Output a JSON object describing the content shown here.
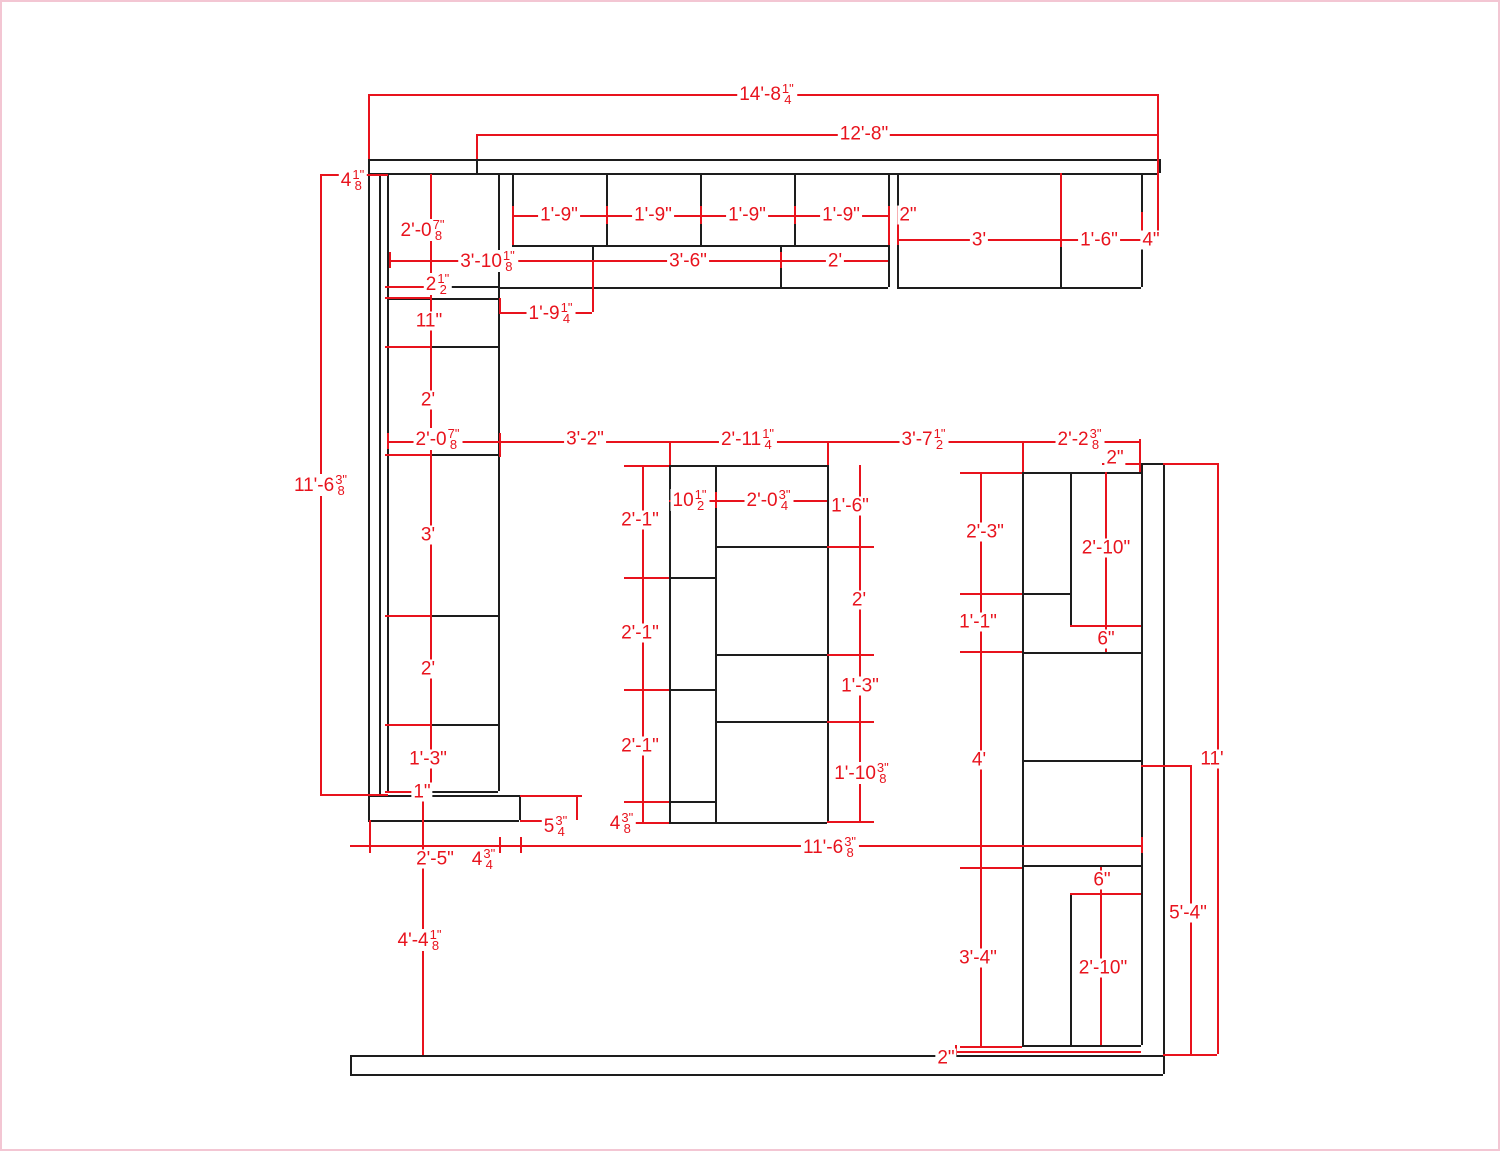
{
  "drawing": {
    "title": "cabinet-layout-plan",
    "colors": {
      "background": "#ffffff",
      "page_border": "#f3c6d3",
      "cabinet_line": "#1d1d1d",
      "dimension_line": "#e8131d"
    },
    "cabinet_lines": [
      [
        366,
        157,
        1157,
        157
      ],
      [
        366,
        171,
        1157,
        171
      ],
      [
        1157,
        157,
        1157,
        171
      ],
      [
        474,
        157,
        474,
        171
      ],
      [
        366,
        157,
        366,
        818
      ],
      [
        377,
        171,
        377,
        793
      ],
      [
        385,
        171,
        385,
        789
      ],
      [
        496,
        171,
        496,
        789
      ],
      [
        385,
        284,
        496,
        284
      ],
      [
        385,
        296,
        496,
        296
      ],
      [
        385,
        344,
        496,
        344
      ],
      [
        385,
        452,
        496,
        452
      ],
      [
        385,
        613,
        496,
        613
      ],
      [
        385,
        722,
        496,
        722
      ],
      [
        385,
        789,
        496,
        789
      ],
      [
        366,
        793,
        517,
        793
      ],
      [
        366,
        818,
        517,
        818
      ],
      [
        517,
        793,
        517,
        818
      ],
      [
        510,
        171,
        510,
        243
      ],
      [
        604,
        171,
        604,
        243
      ],
      [
        698,
        171,
        698,
        243
      ],
      [
        792,
        171,
        792,
        243
      ],
      [
        886,
        171,
        886,
        285
      ],
      [
        895,
        171,
        895,
        285
      ],
      [
        510,
        243,
        886,
        243
      ],
      [
        496,
        285,
        886,
        285
      ],
      [
        590,
        243,
        590,
        285
      ],
      [
        778,
        243,
        778,
        285
      ],
      [
        1058,
        171,
        1058,
        285
      ],
      [
        1139,
        171,
        1139,
        285
      ],
      [
        895,
        285,
        1139,
        285
      ],
      [
        667,
        463,
        825,
        463
      ],
      [
        667,
        820,
        825,
        820
      ],
      [
        667,
        463,
        667,
        820
      ],
      [
        713,
        463,
        713,
        820
      ],
      [
        825,
        463,
        825,
        820
      ],
      [
        667,
        575,
        713,
        575
      ],
      [
        667,
        687,
        713,
        687
      ],
      [
        667,
        799,
        713,
        799
      ],
      [
        713,
        544,
        825,
        544
      ],
      [
        713,
        652,
        825,
        652
      ],
      [
        713,
        719,
        825,
        719
      ],
      [
        1139,
        461,
        1139,
        1043
      ],
      [
        1161,
        461,
        1161,
        1072
      ],
      [
        1139,
        461,
        1161,
        461
      ],
      [
        1020,
        470,
        1020,
        1043
      ],
      [
        1020,
        470,
        1139,
        470
      ],
      [
        1068,
        470,
        1068,
        623
      ],
      [
        1020,
        591,
        1068,
        591
      ],
      [
        1068,
        623,
        1139,
        623
      ],
      [
        1020,
        650,
        1139,
        650
      ],
      [
        1020,
        758,
        1139,
        758
      ],
      [
        1020,
        863,
        1139,
        863
      ],
      [
        1068,
        891,
        1139,
        891
      ],
      [
        1068,
        891,
        1068,
        1043
      ],
      [
        1020,
        1043,
        1139,
        1043
      ],
      [
        348,
        1053,
        1161,
        1053
      ],
      [
        348,
        1072,
        1161,
        1072
      ],
      [
        348,
        1053,
        348,
        1072
      ]
    ],
    "dimension_lines": [
      [
        366,
        92,
        1155,
        92
      ],
      [
        366,
        92,
        366,
        157
      ],
      [
        1155,
        92,
        1155,
        240
      ],
      [
        474,
        132,
        1155,
        132
      ],
      [
        474,
        132,
        474,
        157
      ],
      [
        318,
        172,
        386,
        172
      ],
      [
        318,
        172,
        318,
        792
      ],
      [
        318,
        792,
        386,
        792
      ],
      [
        428,
        172,
        428,
        789
      ],
      [
        510,
        213,
        886,
        213
      ],
      [
        510,
        204,
        510,
        243
      ],
      [
        604,
        204,
        604,
        222
      ],
      [
        698,
        204,
        698,
        222
      ],
      [
        792,
        204,
        792,
        222
      ],
      [
        886,
        204,
        886,
        243
      ],
      [
        895,
        204,
        895,
        243
      ],
      [
        895,
        237,
        1157,
        237
      ],
      [
        1058,
        171,
        1058,
        245
      ],
      [
        1139,
        210,
        1139,
        245
      ],
      [
        387,
        258,
        886,
        258
      ],
      [
        387,
        250,
        387,
        266
      ],
      [
        590,
        258,
        590,
        310
      ],
      [
        778,
        250,
        778,
        266
      ],
      [
        383,
        284,
        428,
        284
      ],
      [
        383,
        295,
        428,
        295
      ],
      [
        383,
        344,
        428,
        344
      ],
      [
        497,
        310,
        590,
        310
      ],
      [
        497,
        296,
        497,
        310
      ],
      [
        383,
        452,
        428,
        452
      ],
      [
        383,
        613,
        428,
        613
      ],
      [
        383,
        722,
        428,
        722
      ],
      [
        383,
        789,
        428,
        789
      ],
      [
        385,
        439,
        1139,
        439
      ],
      [
        385,
        431,
        385,
        447
      ],
      [
        497,
        431,
        497,
        455
      ],
      [
        667,
        439,
        667,
        463
      ],
      [
        825,
        439,
        825,
        463
      ],
      [
        1020,
        439,
        1020,
        470
      ],
      [
        1137,
        437,
        1137,
        470
      ],
      [
        622,
        463,
        667,
        463
      ],
      [
        622,
        575,
        667,
        575
      ],
      [
        622,
        687,
        667,
        687
      ],
      [
        622,
        799,
        667,
        799
      ],
      [
        622,
        820,
        667,
        820
      ],
      [
        640,
        463,
        640,
        820
      ],
      [
        667,
        498,
        825,
        498
      ],
      [
        713,
        490,
        713,
        506
      ],
      [
        857,
        463,
        857,
        819
      ],
      [
        825,
        544,
        872,
        544
      ],
      [
        825,
        652,
        872,
        652
      ],
      [
        825,
        719,
        872,
        719
      ],
      [
        825,
        819,
        872,
        819
      ],
      [
        978,
        470,
        978,
        1044
      ],
      [
        958,
        470,
        1020,
        470
      ],
      [
        958,
        591,
        1020,
        591
      ],
      [
        958,
        649,
        1020,
        649
      ],
      [
        958,
        865,
        1020,
        865
      ],
      [
        958,
        1044,
        1020,
        1044
      ],
      [
        1103,
        470,
        1103,
        650
      ],
      [
        1068,
        623,
        1139,
        623
      ],
      [
        1100,
        461,
        1137,
        461
      ],
      [
        1161,
        461,
        1215,
        461
      ],
      [
        1215,
        461,
        1215,
        1052
      ],
      [
        1161,
        1052,
        1215,
        1052
      ],
      [
        1139,
        763,
        1188,
        763
      ],
      [
        1188,
        763,
        1188,
        1052
      ],
      [
        1098,
        865,
        1098,
        1043
      ],
      [
        1068,
        891,
        1139,
        891
      ],
      [
        953,
        1049,
        1139,
        1049
      ],
      [
        953,
        1043,
        953,
        1053
      ],
      [
        348,
        843,
        1139,
        843
      ],
      [
        367,
        818,
        367,
        851
      ],
      [
        497,
        835,
        497,
        851
      ],
      [
        518,
        835,
        518,
        851
      ],
      [
        1139,
        835,
        1139,
        851
      ],
      [
        518,
        793,
        580,
        793
      ],
      [
        574,
        793,
        574,
        818
      ],
      [
        518,
        818,
        563,
        818
      ],
      [
        420,
        793,
        420,
        1053
      ]
    ],
    "dimension_labels": [
      {
        "x": 765,
        "y": 92,
        "text": "14'-8",
        "num": "1\"",
        "den": "4"
      },
      {
        "x": 862,
        "y": 132,
        "text": "12'-8\""
      },
      {
        "x": 351,
        "y": 178,
        "text": "4",
        "num": "1\"",
        "den": "8"
      },
      {
        "x": 557,
        "y": 213,
        "text": "1'-9\""
      },
      {
        "x": 651,
        "y": 213,
        "text": "1'-9\""
      },
      {
        "x": 745,
        "y": 213,
        "text": "1'-9\""
      },
      {
        "x": 839,
        "y": 213,
        "text": "1'-9\""
      },
      {
        "x": 906,
        "y": 213,
        "text": "2\""
      },
      {
        "x": 977,
        "y": 238,
        "text": "3'"
      },
      {
        "x": 1097,
        "y": 238,
        "text": "1'-6\""
      },
      {
        "x": 1149,
        "y": 238,
        "text": "4\""
      },
      {
        "x": 421,
        "y": 228,
        "text": "2'-0",
        "num": "7\"",
        "den": "8"
      },
      {
        "x": 486,
        "y": 259,
        "text": "3'-10",
        "num": "1\"",
        "den": "8"
      },
      {
        "x": 686,
        "y": 259,
        "text": "3'-6\""
      },
      {
        "x": 833,
        "y": 259,
        "text": "2'"
      },
      {
        "x": 436,
        "y": 282,
        "text": "2",
        "num": "1\"",
        "den": "2"
      },
      {
        "x": 427,
        "y": 319,
        "text": "11\""
      },
      {
        "x": 549,
        "y": 311,
        "text": "1'-9",
        "num": "1\"",
        "den": "4"
      },
      {
        "x": 426,
        "y": 398,
        "text": "2'"
      },
      {
        "x": 319,
        "y": 483,
        "text": "11'-6",
        "num": "3\"",
        "den": "8"
      },
      {
        "x": 436,
        "y": 437,
        "text": "2'-0",
        "num": "7\"",
        "den": "8"
      },
      {
        "x": 583,
        "y": 437,
        "text": "3'-2\""
      },
      {
        "x": 746,
        "y": 437,
        "text": "2'-11",
        "num": "1\"",
        "den": "4"
      },
      {
        "x": 922,
        "y": 437,
        "text": "3'-7",
        "num": "1\"",
        "den": "2"
      },
      {
        "x": 1078,
        "y": 437,
        "text": "2'-2",
        "num": "3\"",
        "den": "8"
      },
      {
        "x": 1113,
        "y": 456,
        "text": "2\""
      },
      {
        "x": 688,
        "y": 498,
        "text": "10",
        "num": "1\"",
        "den": "2"
      },
      {
        "x": 767,
        "y": 498,
        "text": "2'-0",
        "num": "3\"",
        "den": "4"
      },
      {
        "x": 848,
        "y": 504,
        "text": "1'-6\""
      },
      {
        "x": 638,
        "y": 518,
        "text": "2'-1\""
      },
      {
        "x": 983,
        "y": 530,
        "text": "2'-3\""
      },
      {
        "x": 426,
        "y": 533,
        "text": "3'"
      },
      {
        "x": 1104,
        "y": 546,
        "text": "2'-10\""
      },
      {
        "x": 857,
        "y": 598,
        "text": "2'"
      },
      {
        "x": 976,
        "y": 620,
        "text": "1'-1\""
      },
      {
        "x": 638,
        "y": 631,
        "text": "2'-1\""
      },
      {
        "x": 1104,
        "y": 637,
        "text": "6\""
      },
      {
        "x": 426,
        "y": 667,
        "text": "2'"
      },
      {
        "x": 858,
        "y": 684,
        "text": "1'-3\""
      },
      {
        "x": 638,
        "y": 744,
        "text": "2'-1\""
      },
      {
        "x": 426,
        "y": 757,
        "text": "1'-3\""
      },
      {
        "x": 977,
        "y": 758,
        "text": "4'"
      },
      {
        "x": 1210,
        "y": 757,
        "text": "11'"
      },
      {
        "x": 860,
        "y": 771,
        "text": "1'-10",
        "num": "3\"",
        "den": "8"
      },
      {
        "x": 420,
        "y": 790,
        "text": "1\""
      },
      {
        "x": 620,
        "y": 821,
        "text": "4",
        "num": "3\"",
        "den": "8"
      },
      {
        "x": 554,
        "y": 824,
        "text": "5",
        "num": "3\"",
        "den": "4"
      },
      {
        "x": 828,
        "y": 845,
        "text": "11'-6",
        "num": "3\"",
        "den": "8"
      },
      {
        "x": 433,
        "y": 857,
        "text": "2'-5\""
      },
      {
        "x": 482,
        "y": 857,
        "text": "4",
        "num": "3\"",
        "den": "4"
      },
      {
        "x": 1100,
        "y": 878,
        "text": "6\""
      },
      {
        "x": 1186,
        "y": 911,
        "text": "5'-4\""
      },
      {
        "x": 418,
        "y": 938,
        "text": "4'-4",
        "num": "1\"",
        "den": "8"
      },
      {
        "x": 976,
        "y": 956,
        "text": "3'-4\""
      },
      {
        "x": 1101,
        "y": 966,
        "text": "2'-10\""
      },
      {
        "x": 944,
        "y": 1056,
        "text": "2\""
      }
    ]
  }
}
